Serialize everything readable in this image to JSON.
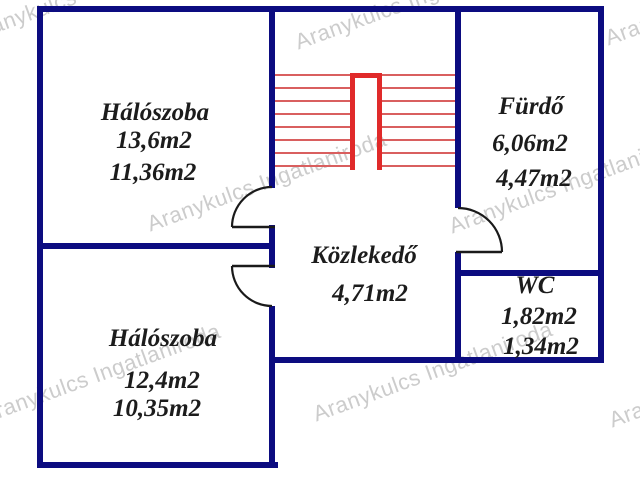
{
  "title": "Emeleti alaprajz",
  "colors": {
    "wall": "#0c0c80",
    "door": "#1a1a1a",
    "stair_tread": "#d95f5f",
    "stair_rail": "#e02a2a",
    "label": "#1c1c1c",
    "watermark": "#cccccc",
    "background": "#ffffff"
  },
  "watermark": {
    "text": "Aranykulcs Ingatlaniroda"
  },
  "rooms": [
    {
      "id": "bedroom-top",
      "name": "Hálószoba",
      "area_gross": "13,6m2",
      "area_net": "11,36m2"
    },
    {
      "id": "bathroom",
      "name": "Fürdő",
      "area_gross": "6,06m2",
      "area_net": "4,47m2"
    },
    {
      "id": "hallway",
      "name": "Közlekedő",
      "area_gross": "4,71m2"
    },
    {
      "id": "wc",
      "name": "WC",
      "area_gross": "1,82m2",
      "area_net": "1,34m2"
    },
    {
      "id": "bedroom-bottom",
      "name": "Hálószoba",
      "area_gross": "12,4m2",
      "area_net": "10,35m2"
    }
  ]
}
